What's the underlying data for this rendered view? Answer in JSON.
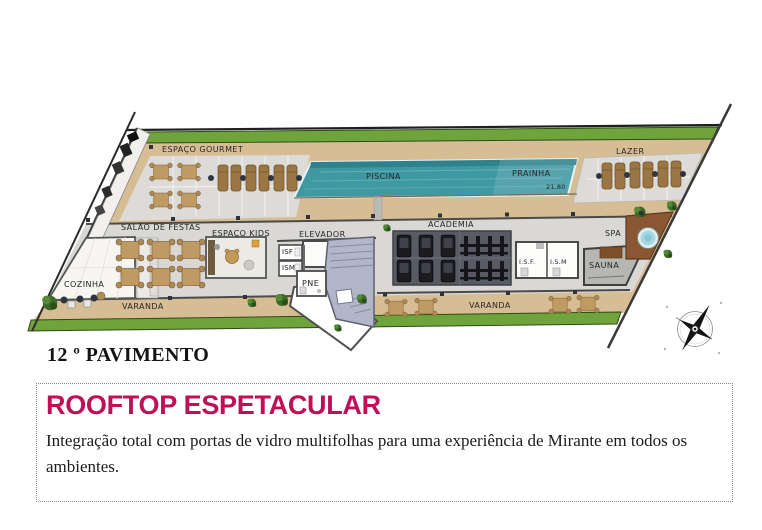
{
  "floor_plan": {
    "floor_label": "12 º PAVIMENTO",
    "labels": {
      "espaco_gourmet": "ESPAÇO GOURMET",
      "piscina": "PISCINA",
      "prainha": "PRAINHA",
      "pool_dimension": "21,80",
      "lazer": "LAZER",
      "salao_de_festas": "SALÃO DE FESTAS",
      "espaco_kids": "ESPAÇO KIDS",
      "elevador": "ELEVADOR",
      "isf_core": "ISF",
      "ism_core": "ISM",
      "pne": "PNE",
      "cozinha": "COZINHA",
      "varanda_left": "VARANDA",
      "academia": "ACADEMIA",
      "isf_gym": "I.S.F.",
      "ism_gym": "I.S.M",
      "sauna": "SAUNA",
      "spa": "SPA",
      "varanda_right": "VARANDA"
    }
  },
  "info_box": {
    "title": "ROOFTOP ESPETACULAR",
    "description": "Integração total com portas de vidro multifolhas para uma experiência de Mirante em todos os ambientes."
  },
  "colors": {
    "accent_magenta": "#C00F56",
    "pool_teal": "#3F99A2",
    "lawn_green": "#6FA43C",
    "deck_wood": "#D7BD94",
    "tile_gray": "#DCDBD8",
    "gym_mat": "#585A64",
    "stair_lilac": "#B2B6C9"
  },
  "icons": {
    "compass": "compass-rose"
  }
}
